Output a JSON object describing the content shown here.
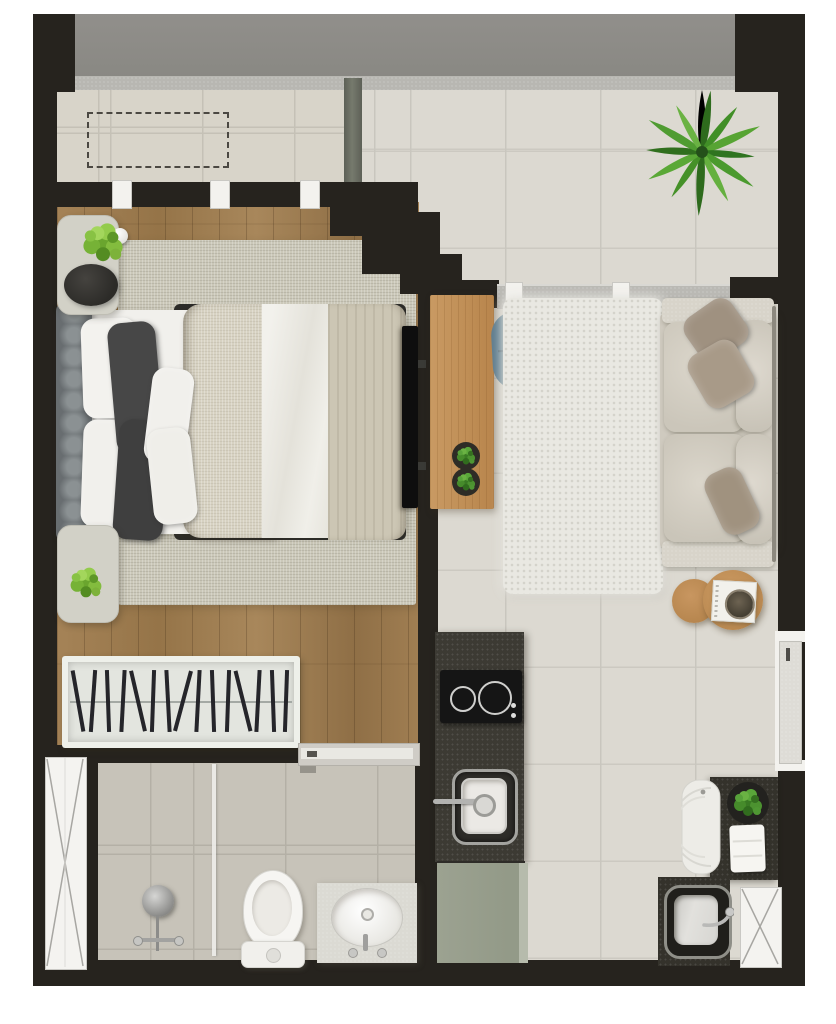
{
  "scene": {
    "label": "studio apartment floor plan, top-down 3D render",
    "width_px": 836,
    "height_px": 1024
  },
  "palette": {
    "wall": "#26231e",
    "slab": "#8f8e8a",
    "sill": "#b8b7b2",
    "tile_living": "#dcd9d1",
    "tile_balcony": "#d8d4c9",
    "tile_bath": "#c7c3b9",
    "wood_floor": "#9d7c51",
    "rug_bedroom": "#cbc8b9",
    "rug_living": "#e9e8e2",
    "headboard": "#757a7c",
    "pillow_white": "#f3f2ee",
    "pillow_dark": "#454545",
    "duvet_beige": "#d7d2c2",
    "sheet_white": "#efeee9",
    "blanket_greige": "#ccc6b4",
    "nightstand": "#d2d1c7",
    "plant_green": "#3f8a26",
    "plant_bright": "#7ab235",
    "desk_wood": "#c18f58",
    "chair_blue": "#5f7d8e",
    "tv_black": "#0e0e0e",
    "sofa": "#d3cec3",
    "sofa_pillow": "#a3947f",
    "table_wood": "#c69257",
    "counter_granite": "#3c3a33",
    "cooktop": "#151515",
    "fridge_sage": "#9aa08f",
    "service_counter": "#34322b",
    "fixture_white": "#f5f4f1",
    "chrome": "#a8a8a6",
    "door_leaf": "#dedcd6",
    "frame_white": "#f3f2ee"
  },
  "rooms": {
    "balcony": {
      "label": "balcony",
      "items": [
        "ac-unit-dashed-outline",
        "window-band",
        "frame-posts x3"
      ]
    },
    "terrace": {
      "label": "terrace-living-front",
      "items": [
        "large-plant",
        "sliding-door-track",
        "frame-posts x2"
      ]
    },
    "bedroom": {
      "label": "bedroom",
      "items": [
        "double-bed",
        "tufted-headboard",
        "white-pillows x2",
        "dark-pillows x2",
        "small-pillows x2",
        "duvet",
        "blanket",
        "area-rug",
        "nightstand x2",
        "table-lamp",
        "plant x2",
        "open-wardrobe",
        "hangers x15",
        "wall-tv",
        "sliding-door"
      ]
    },
    "living": {
      "label": "living-room",
      "items": [
        "desk",
        "desk-plants x2",
        "chair",
        "fluffy-rug",
        "sofa",
        "sofa-pillows x3",
        "coffee-table x2",
        "book-tray"
      ]
    },
    "kitchen": {
      "label": "kitchen",
      "items": [
        "granite-counter",
        "cooktop-2-burners",
        "square-sink",
        "wall-faucet",
        "fridge"
      ]
    },
    "bathroom": {
      "label": "bathroom",
      "items": [
        "shower-head",
        "shower-controls",
        "glass-partition",
        "toilet",
        "vanity-oval-sink",
        "shaft-x-panel"
      ]
    },
    "service": {
      "label": "service-area",
      "items": [
        "dark-counter",
        "washing-machine",
        "plant",
        "folded-towels",
        "deep-sink",
        "shaft-x-panel"
      ]
    },
    "entry": {
      "label": "entry",
      "items": [
        "open-door-leaf",
        "door-handle"
      ]
    }
  },
  "counts": {
    "wardrobe_hangers": 15,
    "plant_leaves": 12,
    "balcony_posts": 3,
    "terrace_posts": 2,
    "burners": 2,
    "sofa_pillows": 3,
    "coffee_tables": 2
  }
}
